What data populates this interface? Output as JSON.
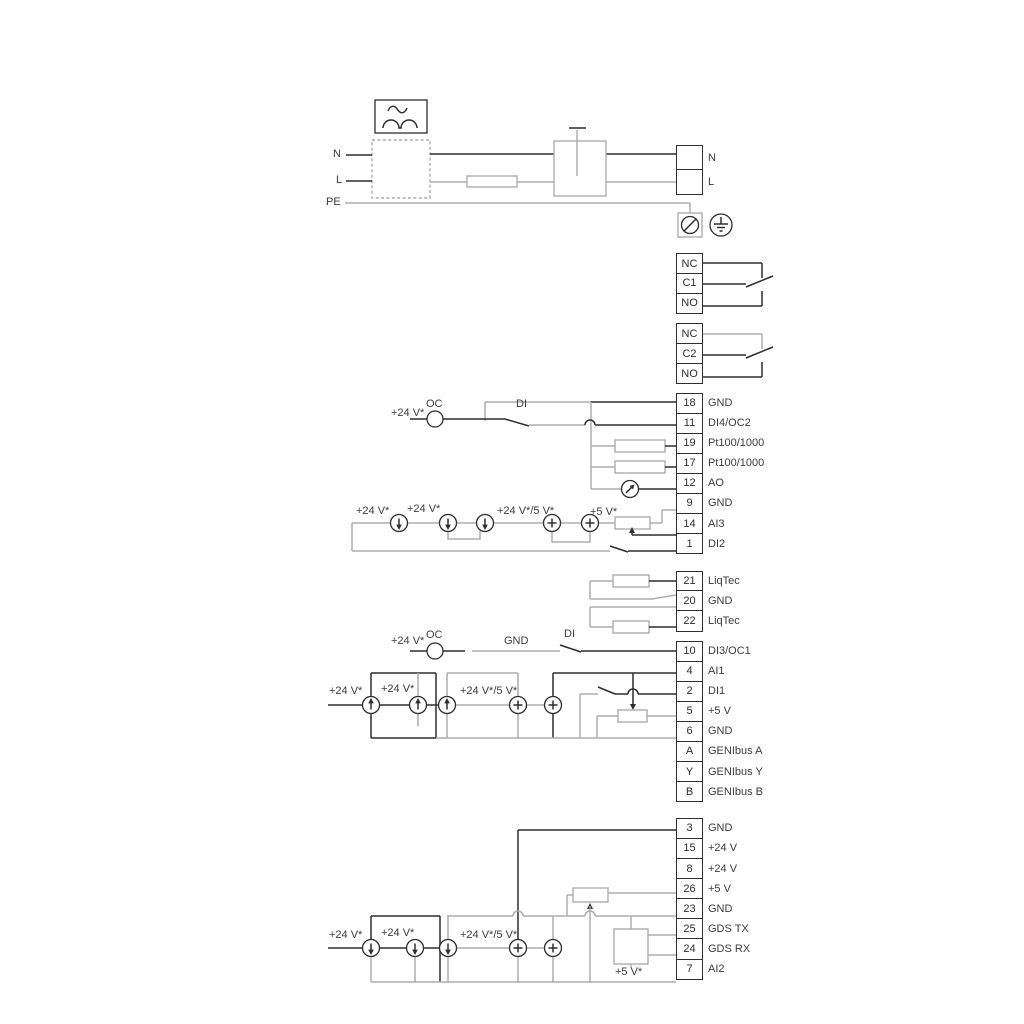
{
  "colors": {
    "wire_dark": "#2e2e2e",
    "wire_gray": "#adadad",
    "text": "#3d3d3d",
    "background": "#ffffff"
  },
  "labels": {
    "v24": "+24 V*",
    "v24_5": "+24 V*/5 V*",
    "v5": "+5 V*",
    "oc": "OC",
    "di": "DI",
    "gnd": "GND",
    "n": "N",
    "l": "L",
    "pe": "PE"
  },
  "icons": {
    "ac_waveform": "~ over ∩∩ (rectified sine symbol)",
    "fuse": "rectangle in line",
    "double_pole_switch": "linked switch contacts in box",
    "protective_earth_terminal": "circle with slash in square",
    "earth_ground": "circle with ground bars",
    "current_source_down": "circle with down arrow",
    "current_source_up": "circle with up arrow",
    "current_source_plus": "circle with plus",
    "analog_meter": "circle with slanted arrow",
    "potentiometer": "rectangle with wiper arrow",
    "gds_sensor": "square box"
  },
  "strips": {
    "power": {
      "cells": [
        {
          "num": "",
          "label": "N"
        },
        {
          "num": "",
          "label": "L"
        }
      ]
    },
    "relay1": {
      "cells": [
        {
          "num": "NC",
          "label": ""
        },
        {
          "num": "C1",
          "label": ""
        },
        {
          "num": "NO",
          "label": ""
        }
      ]
    },
    "relay2": {
      "cells": [
        {
          "num": "NC",
          "label": ""
        },
        {
          "num": "C2",
          "label": ""
        },
        {
          "num": "NO",
          "label": ""
        }
      ]
    },
    "stripA": {
      "cells": [
        {
          "num": "18",
          "label": "GND"
        },
        {
          "num": "11",
          "label": "DI4/OC2"
        },
        {
          "num": "19",
          "label": "Pt100/1000"
        },
        {
          "num": "17",
          "label": "Pt100/1000"
        },
        {
          "num": "12",
          "label": "AO"
        },
        {
          "num": "9",
          "label": "GND"
        },
        {
          "num": "14",
          "label": "AI3"
        },
        {
          "num": "1",
          "label": "DI2"
        }
      ]
    },
    "liqtec": {
      "cells": [
        {
          "num": "21",
          "label": "LiqTec"
        },
        {
          "num": "20",
          "label": "GND"
        },
        {
          "num": "22",
          "label": "LiqTec"
        }
      ]
    },
    "stripB": {
      "cells": [
        {
          "num": "10",
          "label": "DI3/OC1"
        },
        {
          "num": "4",
          "label": "AI1"
        },
        {
          "num": "2",
          "label": "DI1"
        },
        {
          "num": "5",
          "label": "+5 V"
        },
        {
          "num": "6",
          "label": "GND"
        },
        {
          "num": "A",
          "label": "GENIbus A"
        },
        {
          "num": "Y",
          "label": "GENIbus Y"
        },
        {
          "num": "B",
          "label": "GENIbus B"
        }
      ]
    },
    "stripC": {
      "cells": [
        {
          "num": "3",
          "label": "GND"
        },
        {
          "num": "15",
          "label": "+24 V"
        },
        {
          "num": "8",
          "label": "+24 V"
        },
        {
          "num": "26",
          "label": "+5 V"
        },
        {
          "num": "23",
          "label": "GND"
        },
        {
          "num": "25",
          "label": "GDS TX"
        },
        {
          "num": "24",
          "label": "GDS RX"
        },
        {
          "num": "7",
          "label": "AI2"
        }
      ]
    }
  }
}
